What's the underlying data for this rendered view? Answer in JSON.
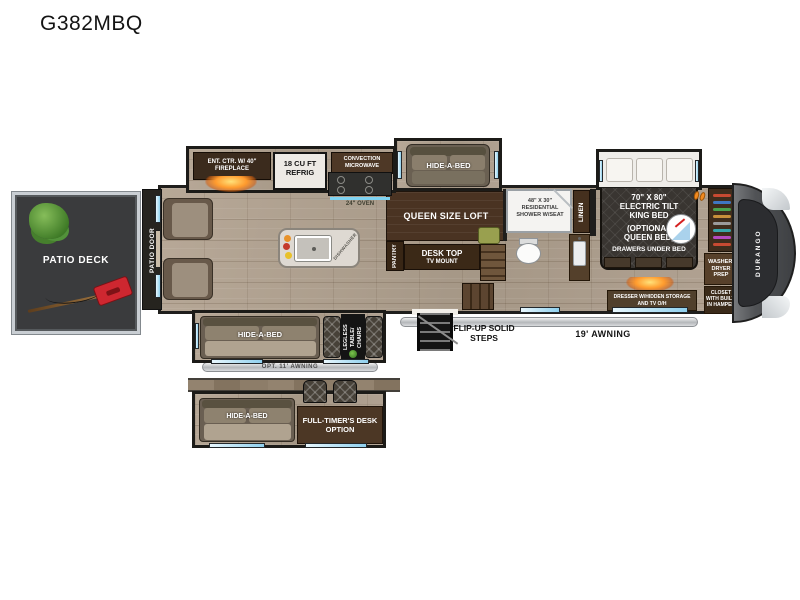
{
  "title": "G382MBQ",
  "plan": {
    "patio_deck": "PATIO DECK",
    "patio_door": "PATIO DOOR",
    "ent_ctr": "ENT. CTR. W/ 40\" FIREPLACE",
    "refrig": "18 CU FT REFRIG",
    "microwave": "CONVECTION MICROWAVE",
    "oven": "24\" OVEN",
    "dishwasher": "DISHWASHER",
    "hide_a_bed_top": "HIDE-A-BED",
    "queen_loft": "QUEEN SIZE LOFT",
    "pantry": "PANTRY",
    "desk_line1": "DESK TOP",
    "desk_line2": "TV MOUNT",
    "shower": "48\" X 30\" RESIDENTIAL SHOWER W/SEAT",
    "linen": "LINEN",
    "bed_size": "70\" X 80\"",
    "bed_type": "ELECTRIC TILT KING BED",
    "bed_opt": "(OPTIONAL QUEEN BED)",
    "bed_drawers": "DRAWERS UNDER BED",
    "dresser": "DRESSER W/HIDDEN STORAGE AND TV O/H",
    "washer": "WASHER/ DRYER PREP",
    "closet": "CLOSET WITH BUILT-IN HAMPER",
    "brand": "DURANGO",
    "hide_a_bed_mid": "HIDE-A-BED",
    "legless": "LEGLESS TABLE/ CHAIRS",
    "awning_opt": "OPT. 11' AWNING",
    "flip_steps": "FLIP-UP SOLID STEPS",
    "awning_main": "19' AWNING",
    "hide_a_bed_opt": "HIDE-A-BED",
    "full_timer": "FULL-TIMER'S DESK OPTION"
  },
  "colors": {
    "wood": "#b0a293",
    "wall": "#1f1e1c",
    "window_blue": "#8fd0ee",
    "cabinet_brown": "#4e3927",
    "flame_orange": "#ff9b2e",
    "deck_gray": "#3a3b3d",
    "patio_red": "#ce2730",
    "cap_gray": "#4b4c4e",
    "awning_silver": "#b4b7ba"
  }
}
